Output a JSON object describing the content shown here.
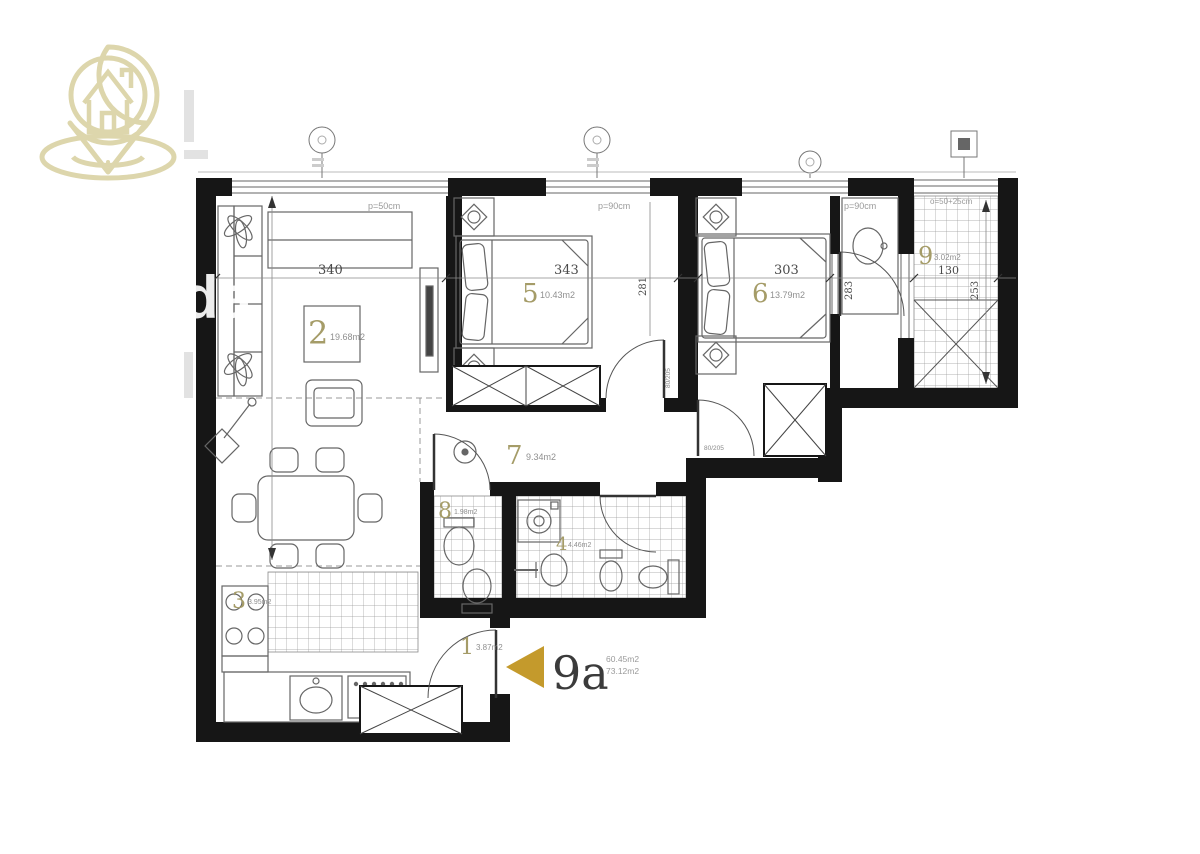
{
  "unit": {
    "label": "9a",
    "area1": "60.45m2",
    "area2": "73.12m2"
  },
  "rooms": [
    {
      "num": "1",
      "area": "3.87m2"
    },
    {
      "num": "2",
      "area": "19.68m2"
    },
    {
      "num": "3",
      "area": "3.95m2"
    },
    {
      "num": "4",
      "area": "4.46m2"
    },
    {
      "num": "5",
      "area": "10.43m2"
    },
    {
      "num": "6",
      "area": "13.79m2"
    },
    {
      "num": "7",
      "area": "9.34m2"
    },
    {
      "num": "8",
      "area": "1.98m2"
    },
    {
      "num": "9",
      "area": "3.02m2"
    }
  ],
  "dims": {
    "living_w": "340",
    "bed5_w": "343",
    "bed6_w": "303",
    "terrace_w": "130",
    "bed5_h": "281",
    "bed6_h": "283",
    "terrace_h": "253"
  },
  "windows": {
    "living": "p=50cm",
    "bed5": "p=90cm",
    "bed6": "p=90cm",
    "terrace": "o=50+25cm"
  },
  "doors": {
    "size": "80/205"
  },
  "watermark": {
    "text": "da"
  },
  "colors": {
    "wall": "#161616",
    "logo": "#ddd6ac",
    "arrow": "#c49a2c",
    "room_number": "#a59c68"
  }
}
